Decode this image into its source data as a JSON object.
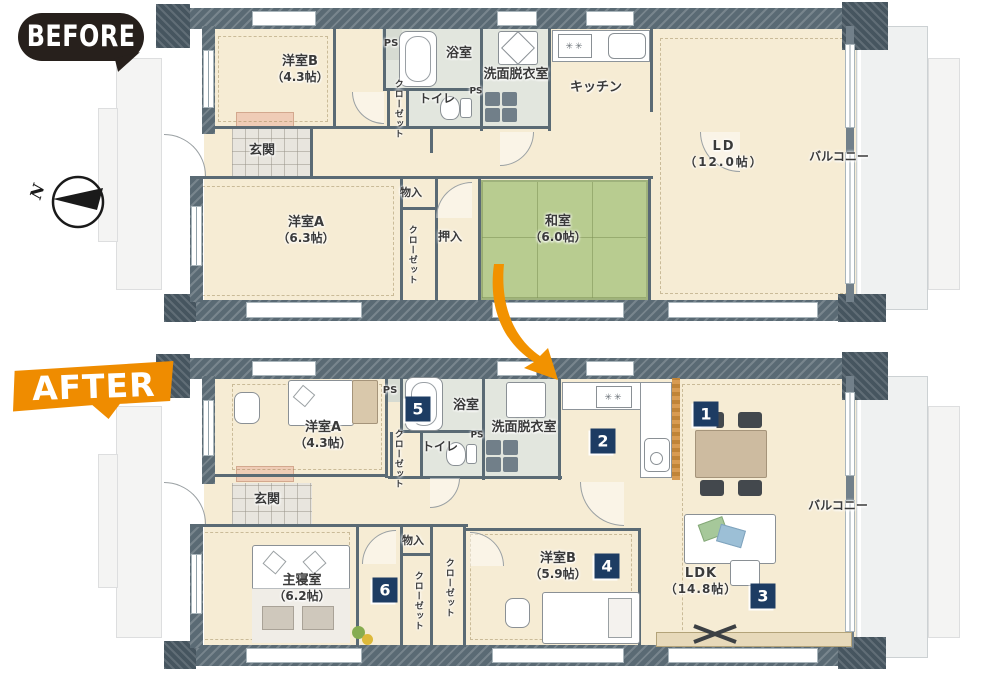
{
  "badges": {
    "before": "BEFORE",
    "after": "AFTER"
  },
  "compass": {
    "n": "N"
  },
  "colors": {
    "accent_orange": "#ef8c00",
    "marker_navy": "#1d3c63",
    "tatami_green": "#b8cc90",
    "wall_slate": "#5a6a74",
    "floor_cream": "#f6ecd4"
  },
  "before": {
    "rooms": {
      "yoshitsu_b": {
        "name": "洋室B",
        "size": "（4.3帖）"
      },
      "ps1": {
        "name": "PS"
      },
      "yokushitsu": {
        "name": "浴室"
      },
      "senmen": {
        "name": "洗面脱衣室"
      },
      "kitchen": {
        "name": "キッチン"
      },
      "closet1": {
        "name": "クローゼット"
      },
      "toilet": {
        "name": "トイレ"
      },
      "ps2": {
        "name": "PS"
      },
      "genkan": {
        "name": "玄関"
      },
      "ld": {
        "name": "LD",
        "size": "（12.0帖）"
      },
      "balcony": {
        "name": "バルコニー"
      },
      "yoshitsu_a": {
        "name": "洋室A",
        "size": "（6.3帖）"
      },
      "monoire": {
        "name": "物入"
      },
      "closet2": {
        "name": "クローゼット"
      },
      "oshiire": {
        "name": "押入"
      },
      "washitsu": {
        "name": "和室",
        "size": "（6.0帖）"
      }
    }
  },
  "after": {
    "rooms": {
      "yoshitsu_a": {
        "name": "洋室A",
        "size": "（4.3帖）"
      },
      "ps1": {
        "name": "PS"
      },
      "yokushitsu": {
        "name": "浴室"
      },
      "senmen": {
        "name": "洗面脱衣室"
      },
      "ps2": {
        "name": "PS"
      },
      "toilet": {
        "name": "トイレ"
      },
      "closet1": {
        "name": "クローゼット"
      },
      "genkan": {
        "name": "玄関"
      },
      "monoire": {
        "name": "物入"
      },
      "closet2": {
        "name": "クローゼット"
      },
      "closet3": {
        "name": "クローゼット"
      },
      "shinshitsu": {
        "name": "主寝室",
        "size": "（6.2帖）"
      },
      "yoshitsu_b": {
        "name": "洋室B",
        "size": "（5.9帖）"
      },
      "ldk": {
        "name": "LDK",
        "size": "（14.8帖）"
      },
      "balcony": {
        "name": "バルコニー"
      }
    },
    "markers": [
      "1",
      "2",
      "3",
      "4",
      "5",
      "6"
    ]
  }
}
